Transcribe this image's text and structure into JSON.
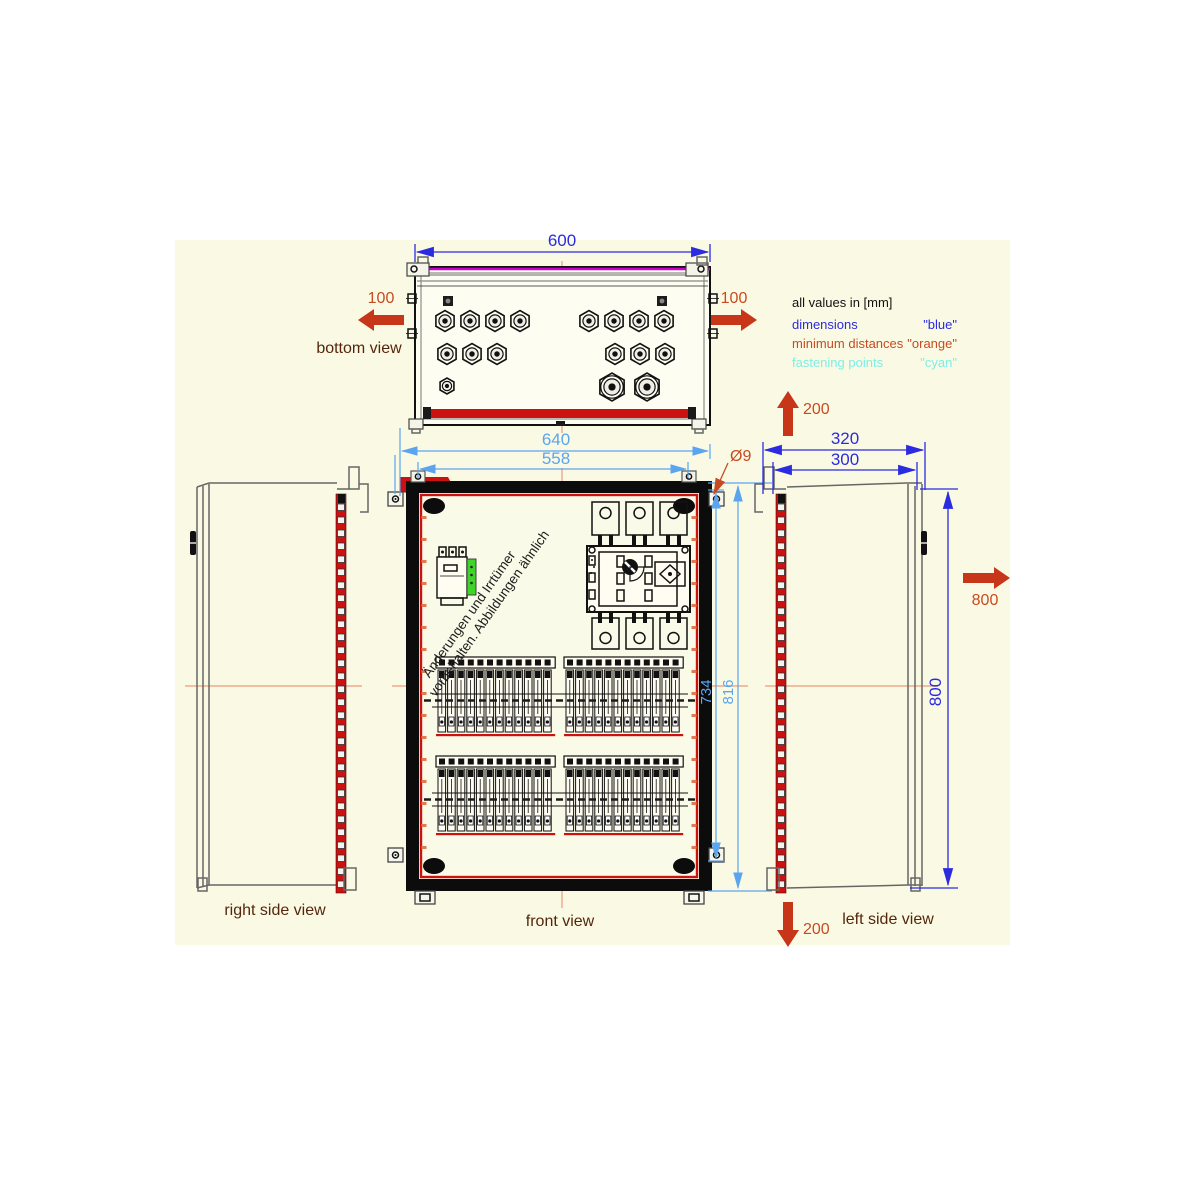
{
  "views": {
    "bottom": "bottom view",
    "front": "front view",
    "right_side": "right side view",
    "left_side": "left side view"
  },
  "legend": {
    "title": "all values in [mm]",
    "rows": [
      {
        "label": "dimensions",
        "value": "\"blue\""
      },
      {
        "label": "minimum distances",
        "value": "\"orange\""
      },
      {
        "label": "fastening points",
        "value": "\"cyan\""
      }
    ]
  },
  "dims": {
    "enclosure_width": "600",
    "fastening_width_outer": "640",
    "fastening_width_holes": "558",
    "fastening_hole_diameter": "Ø9",
    "fastening_height_holes": "734",
    "fastening_height_outer": "816",
    "side_depth_outer": "320",
    "side_depth_body": "300",
    "side_height": "800"
  },
  "min_distances": {
    "left": "100",
    "right": "100",
    "top": "200",
    "bottom": "200",
    "front": "800"
  },
  "watermark": {
    "line1": "Änderungen und Irrtümer",
    "line2": "vorbehalten. Abbildungen ähnlich"
  },
  "colors": {
    "dimension_blue": "#2b2be0",
    "fastening_cyan_dim": "#5aa4f0",
    "fastening_cyan_legend": "#7deee6",
    "minimum_distance_orange": "#c84a20",
    "arrow_orange": "#c8361a",
    "accent_red": "#cc1111",
    "magenta_rail": "#cc00cc",
    "centerline_salmon": "#eba98d",
    "view_label_brown": "#55260d",
    "device_green": "#3fd42a",
    "drawing_background": "#fafae4"
  },
  "components": {
    "glands": {
      "row1_left": 4,
      "row1_right": 4,
      "row2_left": 3,
      "row2_right": 3,
      "row3_small_left": 1,
      "row3_large_right": 2
    },
    "terminal_rows": 2,
    "terminal_groups_per_row": 2,
    "terminals_per_group": 12
  }
}
